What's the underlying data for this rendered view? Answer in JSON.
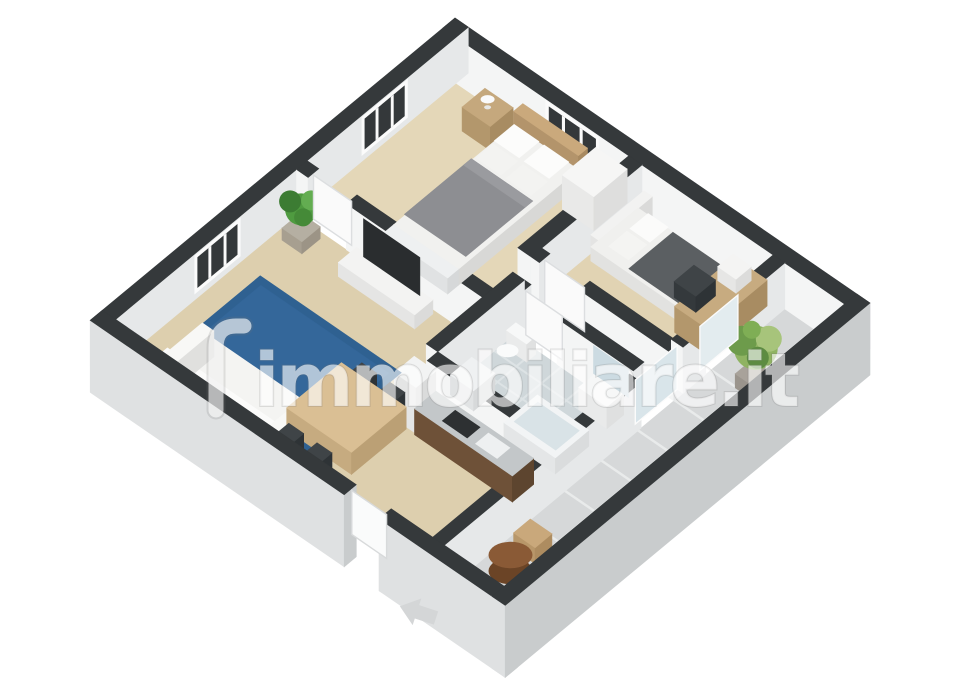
{
  "watermark": {
    "brand": "immobiliare.it",
    "logo_mark": "lighthouse-glyph",
    "fill": "rgba(255,255,255,0.62)",
    "halo": "rgba(115,115,115,0.20)"
  },
  "floorplan": {
    "view": "3d-isometric-cutaway-render",
    "background": "#ffffff",
    "rooms": [
      {
        "name": "master-bedroom",
        "floor": "wood-beige",
        "furniture": [
          "double-bed-gray-duvet",
          "white-pillows",
          "wood-headboard",
          "nightstand",
          "table-lamp",
          "white-dresser"
        ],
        "windows": 2
      },
      {
        "name": "second-bedroom",
        "floor": "wood-beige",
        "furniture": [
          "single-bed-dark-duvet",
          "white-headboard",
          "wood-desk",
          "desk-chair",
          "white-printer"
        ],
        "balcony_door": true
      },
      {
        "name": "bathroom",
        "floor": "light-blue-tile",
        "furniture": [
          "bathtub",
          "toilet",
          "washbasin",
          "mirror",
          "washing-machine"
        ]
      },
      {
        "name": "kitchen",
        "floor": "wood-beige",
        "furniture": [
          "counter-dark-wood",
          "gray-countertop",
          "cooktop",
          "sink",
          "fridge"
        ],
        "entrance_door": true
      },
      {
        "name": "living-dining-room",
        "floor": "wood-beige",
        "furniture": [
          "blue-rug",
          "white-sofa",
          "tv-cabinet",
          "flat-tv",
          "dining-table",
          "dark-chairs-x4",
          "potted-plant"
        ],
        "windows": 1
      },
      {
        "name": "hallway",
        "floor": "wood-beige",
        "furniture": []
      },
      {
        "name": "balcony",
        "floor": "gray-tile",
        "furniture": [
          "palm-plant",
          "round-wood-table",
          "slat-chairs-x2"
        ]
      }
    ],
    "entrance_arrow": {
      "visible": true,
      "points_toward": "entry-door"
    },
    "colors": {
      "wall_top": "#35393b",
      "wall_face_white": "#f4f5f5",
      "wall_face_shade": "#e6e8e9",
      "exterior_face": "#dfe1e2",
      "exterior_face_dark": "#c9cccd",
      "wood_floor": "#ddcfae",
      "balcony_tile": "#d6d8d9",
      "bath_tile": "#cfd7da",
      "rug_blue": "#2f6191",
      "duvet_gray": "#8d8e92",
      "duvet_dark": "#5b5f62",
      "table_wood": "#dabf94",
      "counter_wood": "#6e5138",
      "countertop": "#c3c7c9",
      "chair_dark": "#3f4447",
      "plant_green": "#4f9b40",
      "palm_green": "#8fb362",
      "outdoor_wood": "#8a5a36",
      "arrow_gray": "#d4d6d7"
    }
  }
}
